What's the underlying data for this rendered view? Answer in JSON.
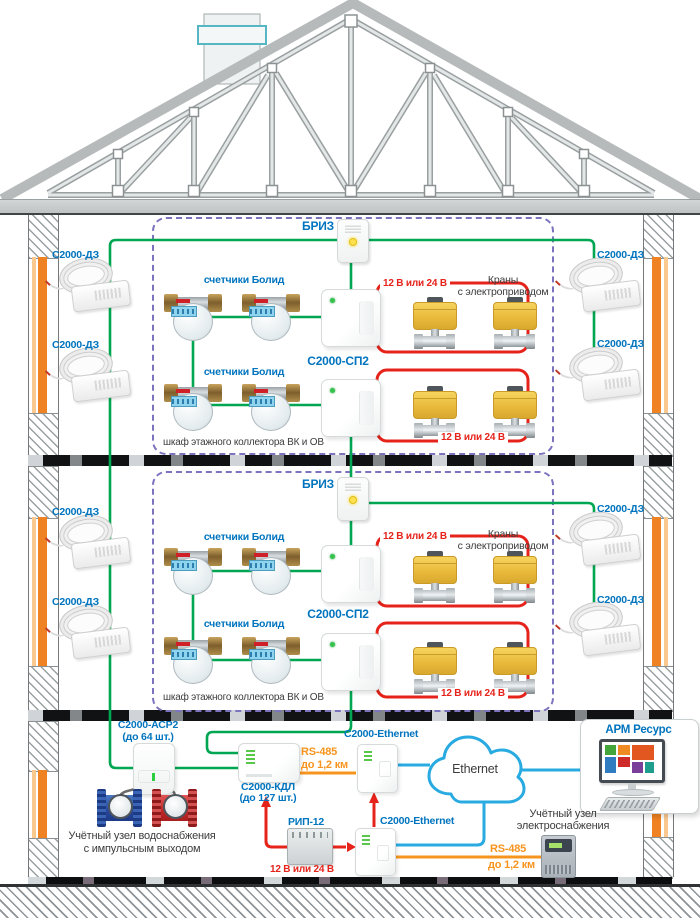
{
  "title": "Схема системы учёта и контроля протечек Болид в многоэтажном доме",
  "colors": {
    "green_wire": "#00A651",
    "red_wire": "#E5231B",
    "orange_wire": "#F7941E",
    "blue_wire": "#29ABE2",
    "label_blue": "#0074BE",
    "cabinet_purple": "#7C73BE",
    "valve_yellow": "#E9BA3B",
    "wall_pipe_orange": "#EF8222"
  },
  "floors": [
    {
      "briz_label": "БРИЗ",
      "sp2_label": "С2000-СП2",
      "meters_label_top": "счетчики Болид",
      "meters_label_bottom": "счетчики Болид",
      "valves_label_line1": "Краны",
      "valves_label_line2": "с электроприводом",
      "power_label_top": "12 В или 24 В",
      "power_label_bottom": "12 В или 24 В",
      "dz_left_top": "С2000-ДЗ",
      "dz_left_bottom": "С2000-ДЗ",
      "dz_right_top": "С2000-ДЗ",
      "dz_right_bottom": "С2000-ДЗ",
      "cabinet_label": "шкаф этажного коллектора ВК и ОВ"
    },
    {
      "briz_label": "БРИЗ",
      "sp2_label": "С2000-СП2",
      "meters_label_top": "счетчики Болид",
      "meters_label_bottom": "счетчики Болид",
      "valves_label_line1": "Краны",
      "valves_label_line2": "с электроприводом",
      "power_label_top": "12 В или 24 В",
      "power_label_bottom": "12 В или 24 В",
      "dz_left_top": "С2000-ДЗ",
      "dz_left_bottom": "С2000-ДЗ",
      "dz_right_top": "С2000-ДЗ",
      "dz_right_bottom": "С2000-ДЗ",
      "cabinet_label": "шкаф этажного коллектора ВК и ОВ"
    }
  ],
  "basement": {
    "asr2_label": "С2000-АСР2",
    "asr2_sub": "(до 64 шт.)",
    "water_unit_line1": "Учётный узел водоснабжения",
    "water_unit_line2": "с импульсным выходом",
    "kdl_label": "С2000-КДЛ",
    "kdl_sub": "(до 127 шт.)",
    "rs485_label": "RS-485",
    "rs485_sub": "до 1,2 км",
    "ethernet_top_label": "C2000-Ethernet",
    "ethernet_bottom_label": "C2000-Ethernet",
    "cloud_label": "Ethernet",
    "arm_label": "АРМ Ресурс",
    "rip_label": "РИП-12",
    "power_label": "12 В или 24 В",
    "rs485_2_label": "RS-485",
    "rs485_2_sub": "до 1,2 км",
    "energy_unit_line1": "Учётный узел",
    "energy_unit_line2": "электроснабжения"
  }
}
